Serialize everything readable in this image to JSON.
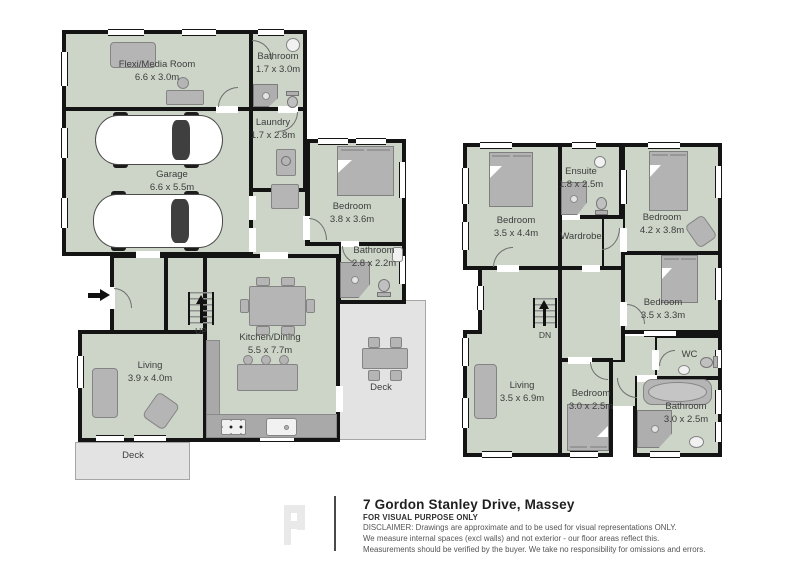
{
  "colors": {
    "room_fill": "#cdd5c8",
    "deck_fill": "#e3e3e3",
    "wall": "#141414",
    "furniture": "#b5b5b5"
  },
  "ground_floor": {
    "rooms": [
      {
        "name": "Flexi/Media Room",
        "dims": "6.6 x 3.0m"
      },
      {
        "name": "Bathroom",
        "dims": "1.7 x 3.0m"
      },
      {
        "name": "Laundry",
        "dims": "1.7 x 2.8m"
      },
      {
        "name": "Garage",
        "dims": "6.6 x 5.5m"
      },
      {
        "name": "Bedroom",
        "dims": "3.8 x 3.6m"
      },
      {
        "name": "Bathroom",
        "dims": "2.8 x 2.2m"
      },
      {
        "name": "Kitchen/Dining",
        "dims": "5.5 x 7.7m"
      },
      {
        "name": "Living",
        "dims": "3.9 x 4.0m"
      }
    ],
    "decks": [
      {
        "label": "Deck"
      },
      {
        "label": "Deck"
      }
    ],
    "stairs_label": "UP"
  },
  "upper_floor": {
    "rooms": [
      {
        "name": "Bedroom",
        "dims": "3.5 x 4.4m"
      },
      {
        "name": "Ensuite",
        "dims": "1.8 x 2.5m"
      },
      {
        "name": "Wardrobe",
        "dims": ""
      },
      {
        "name": "Bedroom",
        "dims": "4.2 x 3.8m"
      },
      {
        "name": "Bedroom",
        "dims": "3.5 x 3.3m"
      },
      {
        "name": "WC",
        "dims": ""
      },
      {
        "name": "Living",
        "dims": "3.5 x 6.9m"
      },
      {
        "name": "Bedroom",
        "dims": "3.0 x 2.5m"
      },
      {
        "name": "Bathroom",
        "dims": "3.0 x 2.5m"
      }
    ],
    "stairs_label": "DN"
  },
  "footer": {
    "title": "7 Gordon Stanley Drive, Massey",
    "purpose": "FOR VISUAL PURPOSE ONLY",
    "disclaimer_line1": "DISCLAIMER:  Drawings are approximate and to be used for visual representations ONLY.",
    "disclaimer_line2": "We measure internal spaces (excl walls) and not exterior - our floor areas reflect this.",
    "disclaimer_line3": "Measurements should be verified by the buyer. We take no responsibility for omissions and errors."
  }
}
